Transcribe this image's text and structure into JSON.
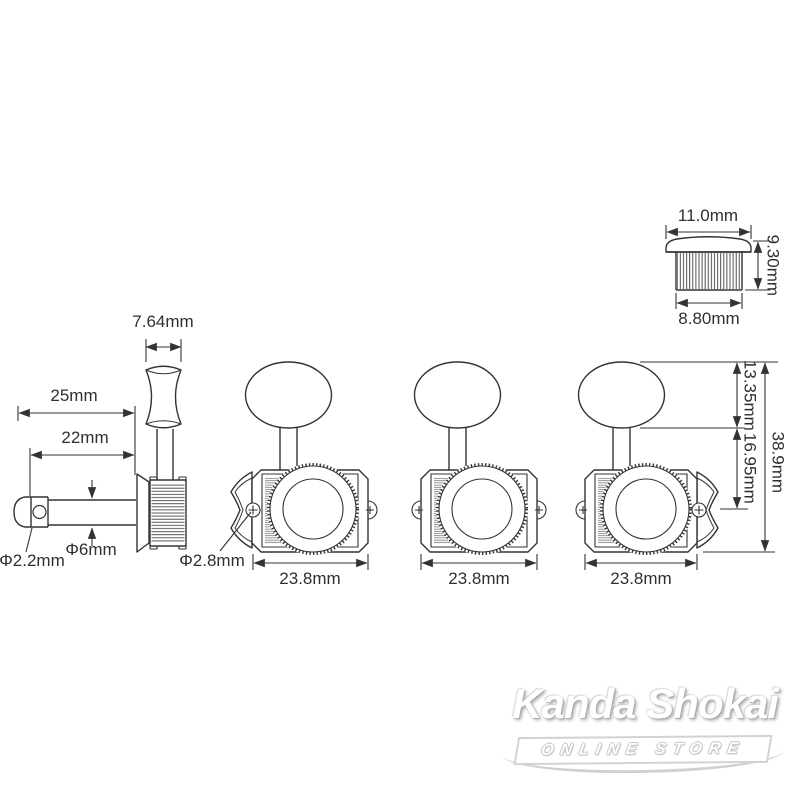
{
  "labels": {
    "button_width": "7.64mm",
    "overall_post_length": "25mm",
    "post_length": "22mm",
    "post_diameter": "Φ6mm",
    "string_hole_diameter": "Φ2.2mm",
    "screw_hole_diameter": "Φ2.8mm",
    "housing_width_1": "23.8mm",
    "housing_width_2": "23.8mm",
    "housing_width_3": "23.8mm",
    "button_height": "13.35mm",
    "housing_height": "16.95mm",
    "overall_height": "38.9mm",
    "bushing_top_diameter": "11.0mm",
    "bushing_height": "9.30mm",
    "bushing_body_diameter": "8.80mm"
  },
  "watermark": {
    "brand": "Kanda Shokai",
    "subtitle": "ONLINE STORE"
  },
  "colors": {
    "line": "#333333",
    "label_text": "#2f2f2f",
    "background": "#ffffff",
    "watermark_gray": "#bdbdbd"
  }
}
